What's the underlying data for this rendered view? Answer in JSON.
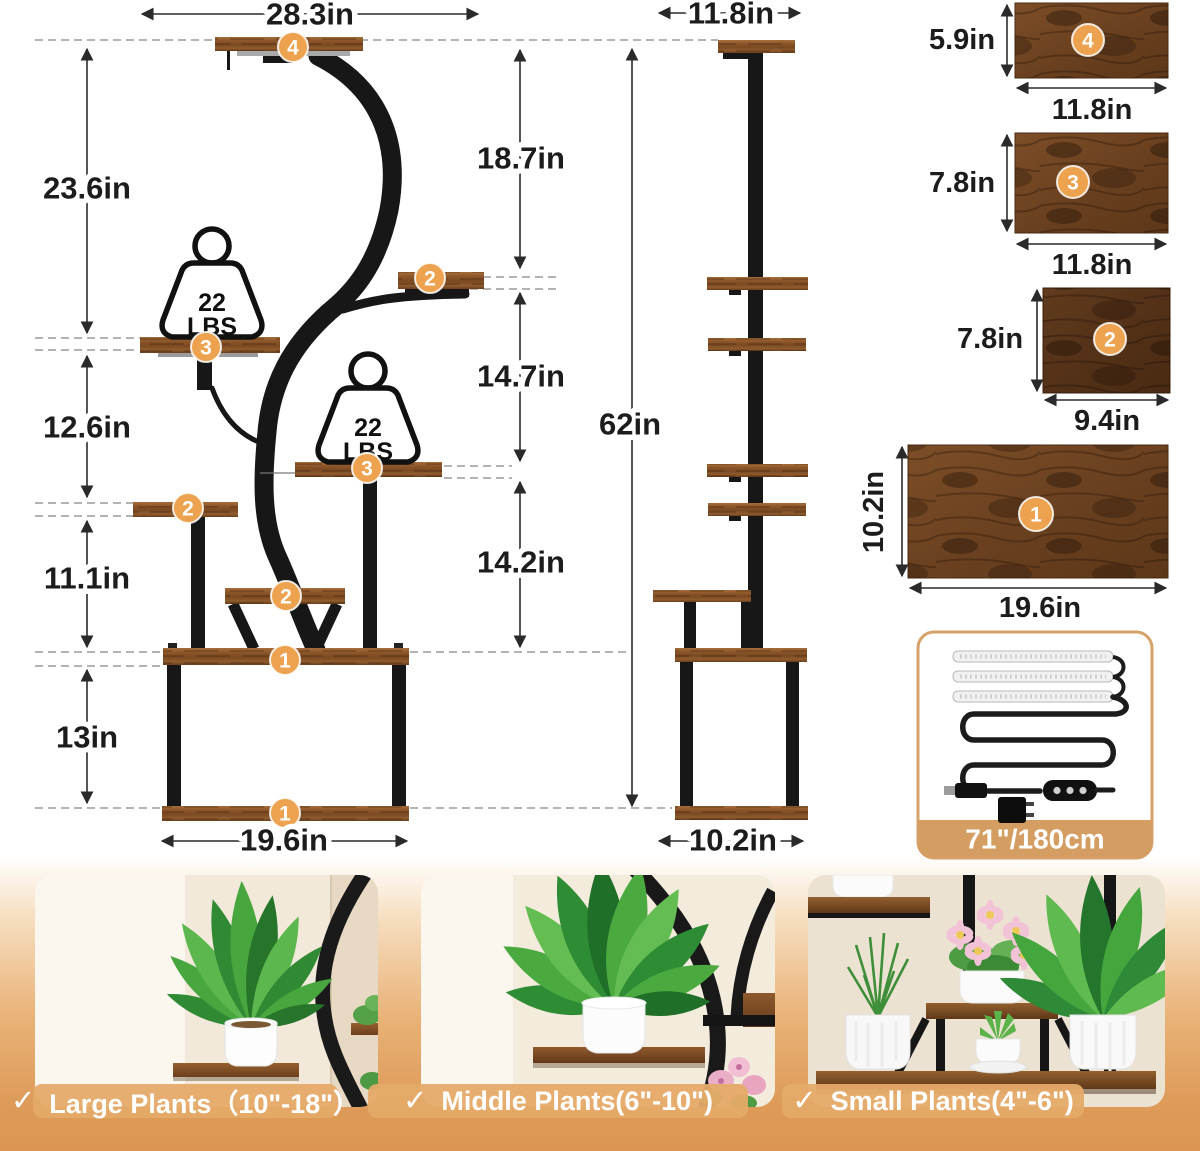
{
  "front_view": {
    "width_top": "28.3in",
    "width_bottom": "19.6in",
    "heights_left": [
      "23.6in",
      "12.6in",
      "11.1in",
      "13in"
    ],
    "heights_right": [
      "18.7in",
      "14.7in",
      "14.2in"
    ],
    "badges": [
      "4",
      "2",
      "3",
      "3",
      "2",
      "2",
      "1",
      "1"
    ],
    "weight_capacity": {
      "value": "22",
      "unit": "LBS"
    }
  },
  "side_view": {
    "width_top": "11.8in",
    "height": "62in",
    "width_bottom": "10.2in"
  },
  "shelf_panels": [
    {
      "num": "4",
      "height": "5.9in",
      "width": "11.8in"
    },
    {
      "num": "3",
      "height": "7.8in",
      "width": "11.8in"
    },
    {
      "num": "2",
      "height": "7.8in",
      "width": "9.4in"
    },
    {
      "num": "1",
      "height": "10.2in",
      "width": "19.6in"
    }
  ],
  "light_kit": {
    "length": "71\"/180cm"
  },
  "photos": [
    {
      "check": "✓",
      "caption": "Large Plants（10\"-18\"）"
    },
    {
      "check": "✓",
      "caption": "Middle Plants(6\"-10\")"
    },
    {
      "check": "✓",
      "caption": "Small Plants(4\"-6\")"
    }
  ],
  "colors": {
    "badge": "#ECA24E",
    "wood": "#7B4A23",
    "steel": "#171717",
    "kit_bar": "#D49E63",
    "bg_bottom": "#DD9A58"
  }
}
